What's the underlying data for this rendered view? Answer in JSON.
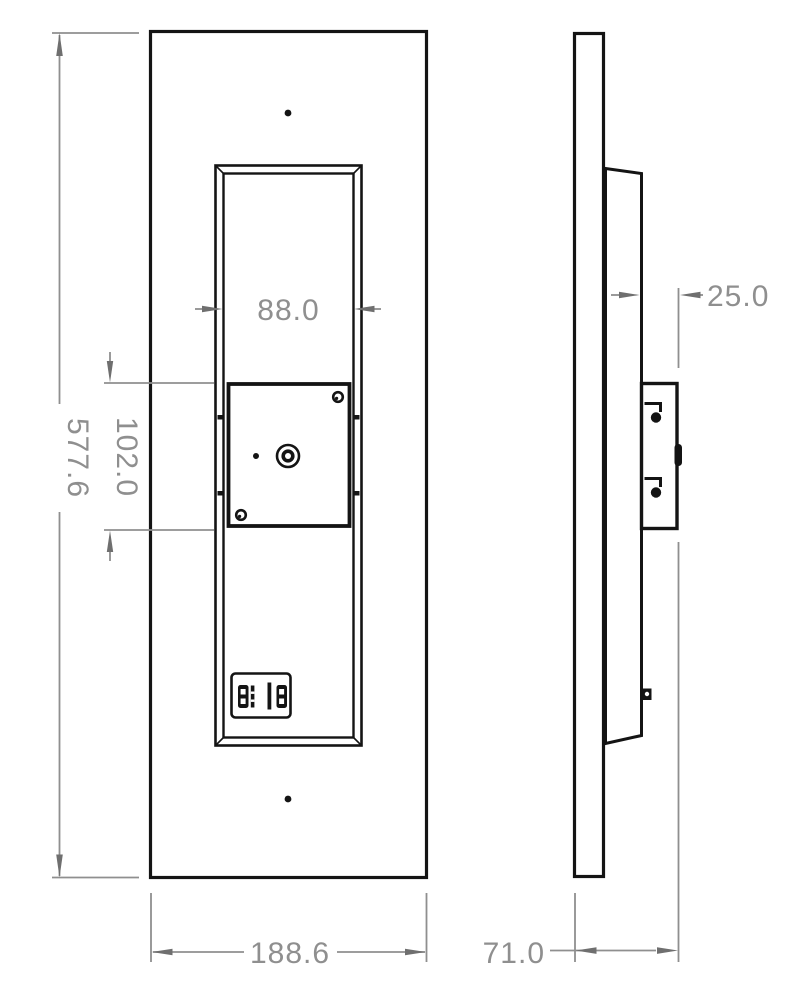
{
  "title": "panel-elevation-and-section-drawing",
  "labels": {
    "overall_height": "577.6",
    "module_height": "102.0",
    "inner_width": "88.0",
    "overall_width": "188.6",
    "bracket_depth": "25.0",
    "overall_depth": "71.0"
  },
  "colors": {
    "line": "#141414",
    "dimension": "#8f8f8f",
    "background": "#ffffff"
  }
}
